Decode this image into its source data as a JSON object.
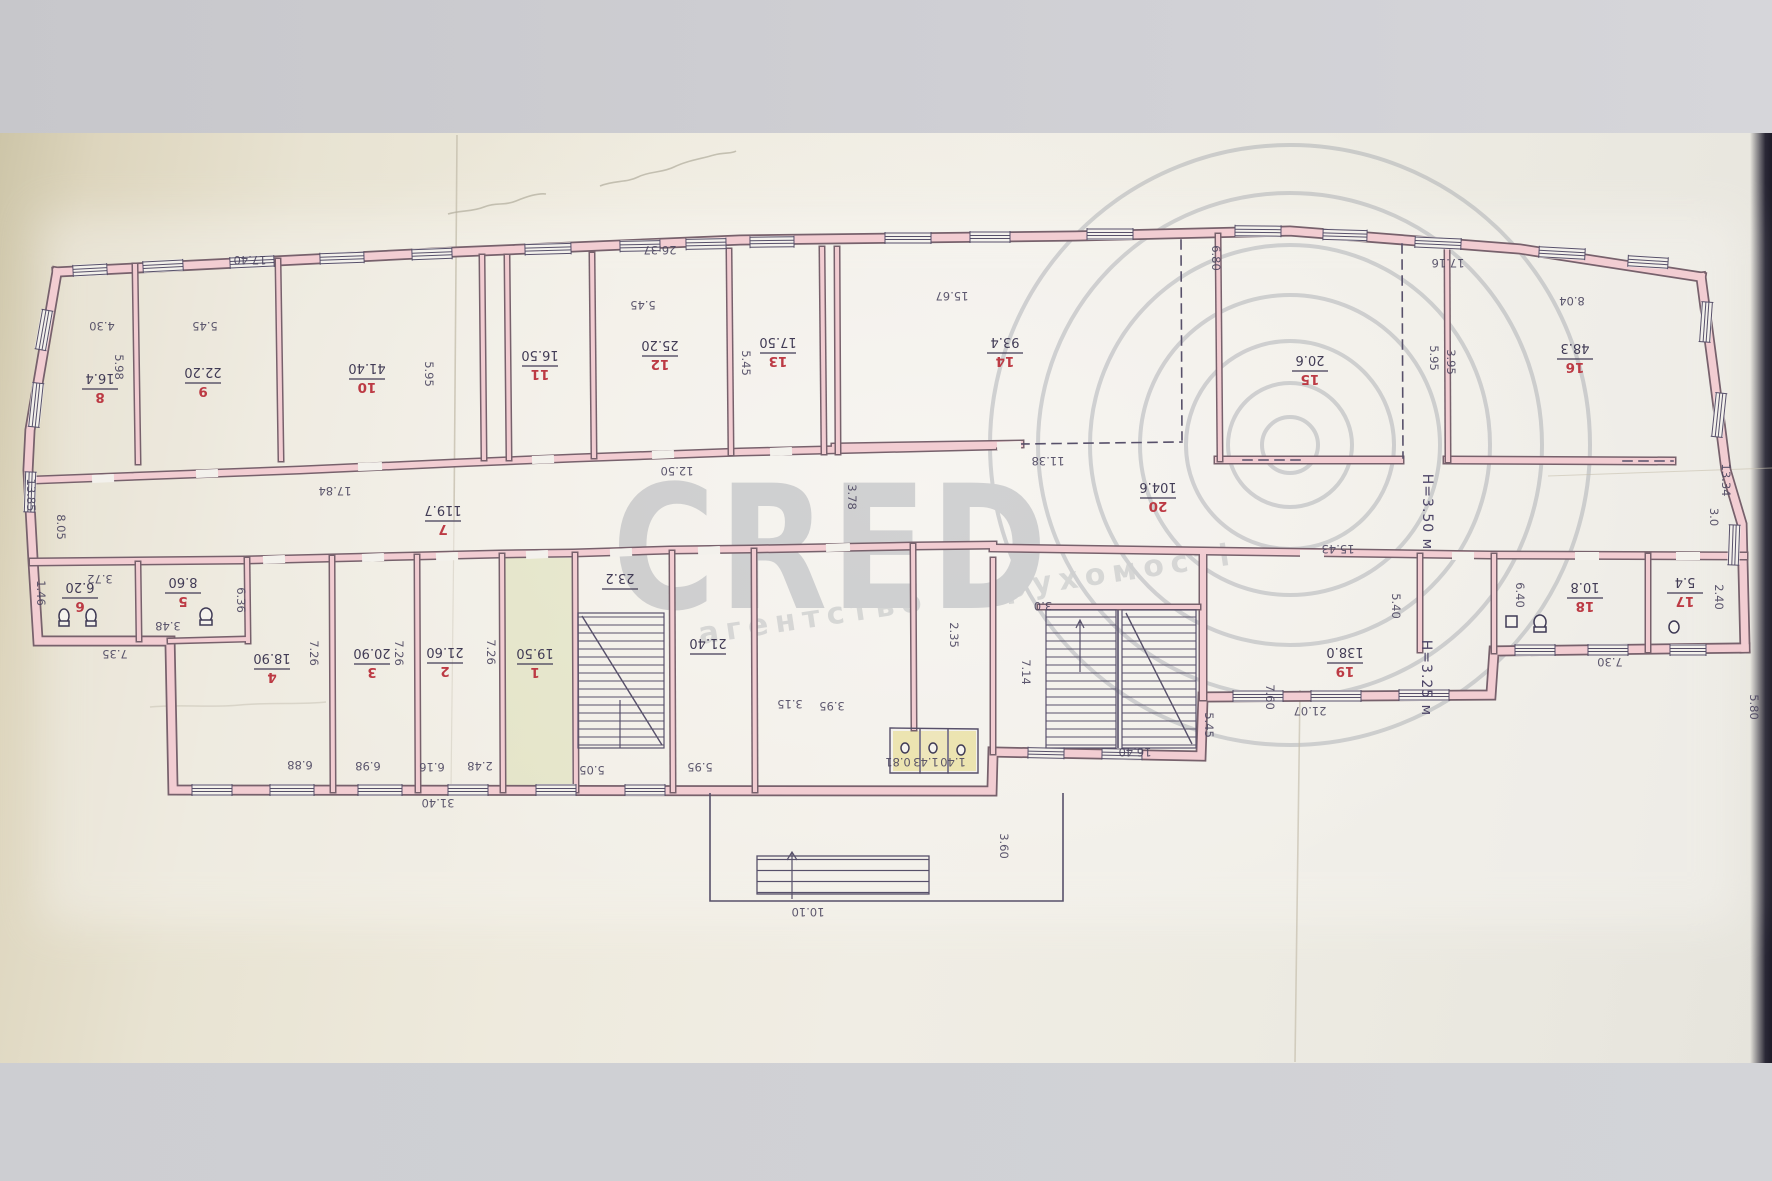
{
  "document_type": "floor-plan-photo",
  "watermark": {
    "brand": "CRED",
    "copyright_symbol": "©",
    "subtitle": "агентство Нерухомості",
    "color": "#878c97"
  },
  "colors": {
    "wall_fill": "#f2cdd2",
    "wall_edge": "#77616c",
    "ink": "#57506a",
    "room_number_red": "#bc3a44",
    "paper": "#eeeadd",
    "photo_band": "#cfcfd4",
    "highlight_yellow": "#e6d87f",
    "highlight_green": "#c4cd82"
  },
  "plan": {
    "heights": [
      {
        "text": "H=3.50 м",
        "x": 1423,
        "y": 512
      },
      {
        "text": "H=3.25 м",
        "x": 1422,
        "y": 678
      }
    ],
    "rooms": [
      {
        "num": "8",
        "area": "16.4",
        "x": 100,
        "y": 388
      },
      {
        "num": "9",
        "area": "22.20",
        "x": 203,
        "y": 382
      },
      {
        "num": "10",
        "area": "41.40",
        "x": 367,
        "y": 378
      },
      {
        "num": "11",
        "area": "16.50",
        "x": 540,
        "y": 365
      },
      {
        "num": "12",
        "area": "25.20",
        "x": 660,
        "y": 355
      },
      {
        "num": "13",
        "area": "17.50",
        "x": 778,
        "y": 352
      },
      {
        "num": "14",
        "area": "93.4",
        "x": 1005,
        "y": 352
      },
      {
        "num": "15",
        "area": "20.6",
        "x": 1310,
        "y": 370
      },
      {
        "num": "16",
        "area": "48.3",
        "x": 1575,
        "y": 358
      },
      {
        "num": "7",
        "area": "119.7",
        "x": 443,
        "y": 520
      },
      {
        "num": "20",
        "area": "104.6",
        "x": 1158,
        "y": 497
      },
      {
        "num": "6",
        "area": "6.20",
        "x": 80,
        "y": 597
      },
      {
        "num": "5",
        "area": "8.60",
        "x": 183,
        "y": 592
      },
      {
        "num": "4",
        "area": "18.90",
        "x": 272,
        "y": 668
      },
      {
        "num": "3",
        "area": "20.90",
        "x": 372,
        "y": 663
      },
      {
        "num": "2",
        "area": "21.60",
        "x": 445,
        "y": 662
      },
      {
        "num": "1",
        "area": "19.50",
        "x": 535,
        "y": 663
      },
      {
        "num": "",
        "area": "23.2",
        "x": 620,
        "y": 588
      },
      {
        "num": "",
        "area": "21.40",
        "x": 708,
        "y": 653
      },
      {
        "num": "19",
        "area": "138.0",
        "x": 1345,
        "y": 662
      },
      {
        "num": "18",
        "area": "10.8",
        "x": 1585,
        "y": 597
      },
      {
        "num": "17",
        "area": "5.4",
        "x": 1685,
        "y": 592
      }
    ],
    "dims": [
      {
        "t": "17.40",
        "x": 250,
        "y": 256,
        "o": "h"
      },
      {
        "t": "26.37",
        "x": 660,
        "y": 246,
        "o": "h"
      },
      {
        "t": "15.67",
        "x": 952,
        "y": 292,
        "o": "h"
      },
      {
        "t": "6.80",
        "x": 1212,
        "y": 258,
        "o": "v"
      },
      {
        "t": "17.16",
        "x": 1448,
        "y": 259,
        "o": "h"
      },
      {
        "t": "8.04",
        "x": 1572,
        "y": 297,
        "o": "h"
      },
      {
        "t": "4.30",
        "x": 102,
        "y": 322,
        "o": "h"
      },
      {
        "t": "5.45",
        "x": 205,
        "y": 322,
        "o": "h"
      },
      {
        "t": "5.98",
        "x": 115,
        "y": 367,
        "o": "v"
      },
      {
        "t": "5.95",
        "x": 425,
        "y": 374,
        "o": "v"
      },
      {
        "t": "5.45",
        "x": 643,
        "y": 301,
        "o": "h"
      },
      {
        "t": "5.45",
        "x": 742,
        "y": 363,
        "o": "v"
      },
      {
        "t": "12.50",
        "x": 677,
        "y": 467,
        "o": "h"
      },
      {
        "t": "17.84",
        "x": 335,
        "y": 487,
        "o": "h"
      },
      {
        "t": "11.38",
        "x": 1048,
        "y": 457,
        "o": "h"
      },
      {
        "t": "3.78",
        "x": 848,
        "y": 497,
        "o": "v"
      },
      {
        "t": "13.85",
        "x": 27,
        "y": 495,
        "o": "v"
      },
      {
        "t": "8.05",
        "x": 57,
        "y": 527,
        "o": "v"
      },
      {
        "t": "13.34",
        "x": 1722,
        "y": 480,
        "o": "v"
      },
      {
        "t": "3.0",
        "x": 1710,
        "y": 517,
        "o": "v"
      },
      {
        "t": "3.72",
        "x": 100,
        "y": 575,
        "o": "h"
      },
      {
        "t": "3.48",
        "x": 168,
        "y": 622,
        "o": "h"
      },
      {
        "t": "6.36",
        "x": 237,
        "y": 600,
        "o": "v"
      },
      {
        "t": "7.35",
        "x": 115,
        "y": 650,
        "o": "h"
      },
      {
        "t": "1.46",
        "x": 37,
        "y": 593,
        "o": "v"
      },
      {
        "t": "7.26",
        "x": 310,
        "y": 653,
        "o": "v"
      },
      {
        "t": "7.26",
        "x": 395,
        "y": 653,
        "o": "v"
      },
      {
        "t": "7.26",
        "x": 487,
        "y": 652,
        "o": "v"
      },
      {
        "t": "6.88",
        "x": 300,
        "y": 761,
        "o": "h"
      },
      {
        "t": "6.98",
        "x": 368,
        "y": 762,
        "o": "h"
      },
      {
        "t": "6.16",
        "x": 432,
        "y": 763,
        "o": "h"
      },
      {
        "t": "2.48",
        "x": 480,
        "y": 762,
        "o": "h"
      },
      {
        "t": "5.05",
        "x": 592,
        "y": 766,
        "o": "h"
      },
      {
        "t": "5.95",
        "x": 700,
        "y": 763,
        "o": "h"
      },
      {
        "t": "31.40",
        "x": 438,
        "y": 799,
        "o": "h"
      },
      {
        "t": "10.10",
        "x": 808,
        "y": 908,
        "o": "h"
      },
      {
        "t": "3.60",
        "x": 1000,
        "y": 846,
        "o": "v"
      },
      {
        "t": "3.15",
        "x": 790,
        "y": 700,
        "o": "h"
      },
      {
        "t": "3.95",
        "x": 832,
        "y": 702,
        "o": "h"
      },
      {
        "t": "0.81",
        "x": 898,
        "y": 758,
        "o": "h"
      },
      {
        "t": "1.43",
        "x": 926,
        "y": 758,
        "o": "h"
      },
      {
        "t": "1.40",
        "x": 953,
        "y": 758,
        "o": "h"
      },
      {
        "t": "2.35",
        "x": 950,
        "y": 635,
        "o": "v"
      },
      {
        "t": "3.0",
        "x": 1043,
        "y": 602,
        "o": "h"
      },
      {
        "t": "7.14",
        "x": 1022,
        "y": 672,
        "o": "v"
      },
      {
        "t": "16.40",
        "x": 1135,
        "y": 748,
        "o": "h"
      },
      {
        "t": "5.45",
        "x": 1205,
        "y": 725,
        "o": "v"
      },
      {
        "t": "7.60",
        "x": 1266,
        "y": 697,
        "o": "v"
      },
      {
        "t": "21.07",
        "x": 1310,
        "y": 707,
        "o": "h"
      },
      {
        "t": "5.80",
        "x": 1750,
        "y": 707,
        "o": "v"
      },
      {
        "t": "7.30",
        "x": 1610,
        "y": 658,
        "o": "h"
      },
      {
        "t": "6.40",
        "x": 1516,
        "y": 595,
        "o": "v"
      },
      {
        "t": "2.40",
        "x": 1715,
        "y": 597,
        "o": "v"
      },
      {
        "t": "5.40",
        "x": 1392,
        "y": 606,
        "o": "v"
      },
      {
        "t": "15.43",
        "x": 1338,
        "y": 545,
        "o": "h"
      },
      {
        "t": "5.95",
        "x": 1430,
        "y": 358,
        "o": "v"
      },
      {
        "t": "3.95",
        "x": 1447,
        "y": 362,
        "o": "v"
      }
    ]
  }
}
